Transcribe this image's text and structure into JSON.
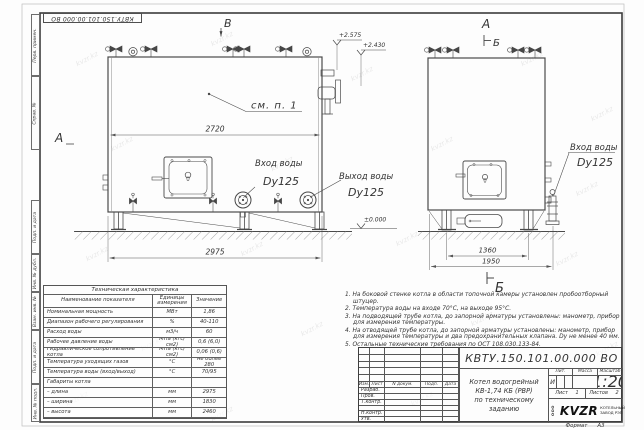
{
  "sheet": {
    "stamp_top": "КВТУ.150.101.00.000 ВО",
    "watermark": "kvzr.kz",
    "format_label": "Формат",
    "format_value": "А3",
    "side_labels": [
      "Перв. примен.",
      "Справ. №",
      "Подп. и дата",
      "Инв. № дубл.",
      "Взам. инв. №",
      "Подп. и дата",
      "Инв. № подл."
    ]
  },
  "drawing": {
    "view_b_top": "В",
    "view_a_left": "А",
    "view_a_right": "А",
    "view_b_right": "Б",
    "section_b_bottom": "Б",
    "note_ref": "см. п. 1",
    "elev_top1": "+2.575",
    "elev_top2": "+2.430",
    "elev_ground": "±0.000",
    "dims": {
      "body_length": "2720",
      "overall_length": "2975",
      "support_span": "1360",
      "overall_width": "1950"
    },
    "labels": {
      "inlet_title": "Вход воды",
      "inlet_dn": "Dy125",
      "outlet_title": "Выход воды",
      "outlet_dn": "Dy125",
      "inlet2_title": "Вход воды",
      "inlet2_dn": "Dy125"
    }
  },
  "tech_table": {
    "title": "Техническая характеристика",
    "col_name": "Наименование показателя",
    "col_units": "Единицы измерения",
    "col_value": "Значение",
    "rows": [
      {
        "name": "Номинальная мощность",
        "units": "МВт",
        "value": "1,86"
      },
      {
        "name": "Диапазон рабочего регулирования",
        "units": "%",
        "value": "40-110"
      },
      {
        "name": "Расход воды",
        "units": "м3/ч",
        "value": "60"
      },
      {
        "name": "Рабочее давление воды",
        "units": "МПа (кгс/см2)",
        "value": "0,6 (6,0)"
      },
      {
        "name": "Гидравлическое сопротивление котла",
        "units": "МПа (кгс/см2)",
        "value": "0,06 (0,6)"
      },
      {
        "name": "Температура уходящих газов",
        "units": "°С",
        "value": "не более 280"
      },
      {
        "name": "Температура воды (вход/выход)",
        "units": "°С",
        "value": "70/95"
      },
      {
        "name": "Габариты котла",
        "units": "",
        "value": ""
      },
      {
        "name": "– длина",
        "units": "мм",
        "value": "2975"
      },
      {
        "name": "– ширина",
        "units": "мм",
        "value": "1830"
      },
      {
        "name": "– высота",
        "units": "мм",
        "value": "2460"
      }
    ]
  },
  "notes": {
    "items": [
      "1.  На боковой стенке котла в области топочной камеры установлен пробоотборный штуцер.",
      "2.  Температура воды на входе 70°С, на выходе 95°С.",
      "3.  На подводящей трубе котла, до запорной арматуры установлены: манометр, прибор для измерения температуры.",
      "4.  На отводящей трубе котла, до запорной арматуры установлены: манометр, прибор для измерения температуры и два предохранительных клапана. Dу не менее 40 мм.",
      "5.  Остальные технические требования по ОСТ 108.030.133-84."
    ]
  },
  "title_block": {
    "designation": "КВТУ.150.101.00.000 ВО",
    "name_line1": "Котел водогрейный",
    "name_line2": "КВ-1,74 КБ (РВР)",
    "name_line3": "по техническому заданию",
    "header_cols": [
      "Изм.",
      "Лист",
      "N докум.",
      "Подп.",
      "Дата"
    ],
    "signer_rows": [
      "Разраб.",
      "Пров.",
      "Т.контр.",
      "",
      "Н.контр.",
      "Утв."
    ],
    "lit_label": "Лит.",
    "mass_label": "Масса",
    "scale_label": "Масштаб",
    "lit_value": "И",
    "mass_value": "",
    "scale_value": "1:20",
    "sheet_label": "Лист",
    "sheet_value": "1",
    "sheets_label": "Листов",
    "sheets_value": "2",
    "company_prefix": "ООО",
    "company_logo": "KVZR",
    "company_name1": "КОТЕЛЬНЫЙ",
    "company_name2": "ЗАВОД РЭП"
  }
}
